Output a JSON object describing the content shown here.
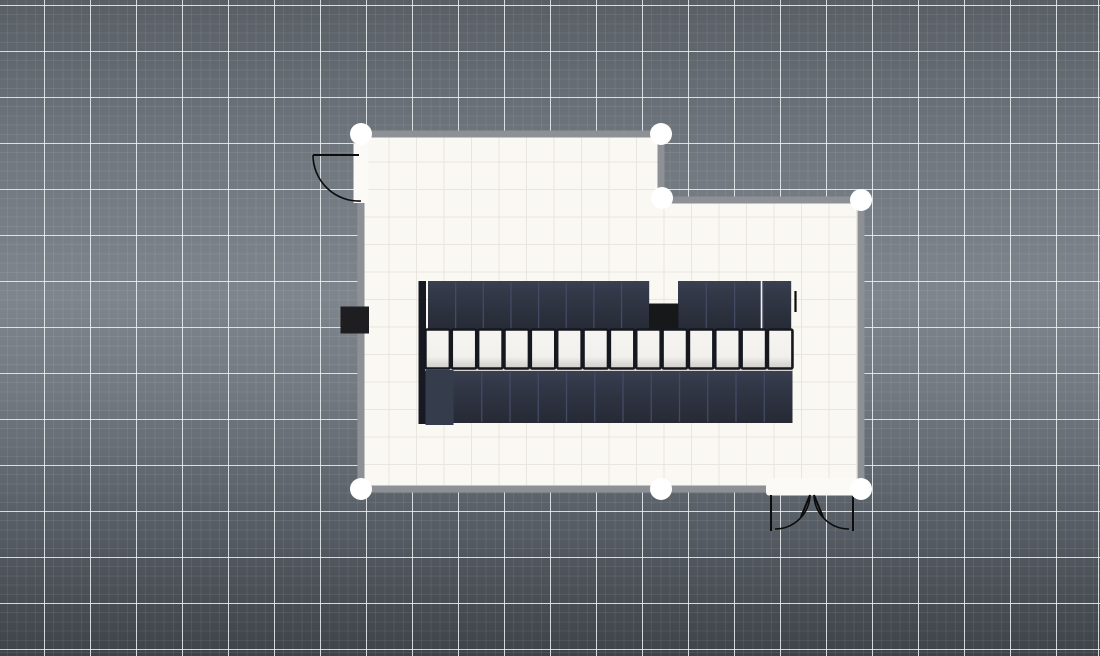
{
  "canvas": {
    "width": 1100,
    "height": 656,
    "background_stops": [
      [
        "#585e64",
        0
      ],
      [
        "#6f767d",
        22
      ],
      [
        "#7e858c",
        45
      ],
      [
        "#747b82",
        58
      ],
      [
        "#575d64",
        80
      ],
      [
        "#3e4349",
        100
      ]
    ],
    "grid": {
      "minor_step": 9.2,
      "major_step": 46,
      "minor_color": "rgba(255,255,255,0.07)",
      "major_color": "rgba(241,245,248,0.82)",
      "offset_x": -2,
      "offset_y": -6
    }
  },
  "room": {
    "floor_color": "#faf8f2",
    "floor_grid": {
      "step": 27.5,
      "color": "#e9e6e0",
      "origin_x": 361,
      "origin_y": 134
    },
    "wall": {
      "color": "#8d9094",
      "thickness": 7
    },
    "outline": [
      [
        361,
        134
      ],
      [
        661,
        134
      ],
      [
        661,
        200
      ],
      [
        861,
        200
      ],
      [
        861,
        489
      ],
      [
        361,
        489
      ]
    ],
    "handles": {
      "radius": 11,
      "color": "#ffffff",
      "points": [
        [
          361,
          134
        ],
        [
          661,
          134
        ],
        [
          662,
          198
        ],
        [
          861,
          200
        ],
        [
          861,
          489
        ],
        [
          661,
          489
        ],
        [
          361,
          489
        ]
      ]
    },
    "doors": {
      "stroke": "#0c0c0c",
      "gap_color": "#fbfaf6",
      "single_left": {
        "gap": [
          353.5,
          144,
          15,
          59
        ],
        "leaf": [
          313,
          155,
          359,
          155
        ],
        "arc": "M 313 155 A 46 46 0 0 0 361 201"
      },
      "double_bottom": {
        "gap": [
          766,
          478.5,
          92,
          17
        ],
        "jambs": [
          [
            771,
            495,
            771,
            531
          ],
          [
            853,
            495,
            853,
            531
          ]
        ],
        "leaves": [
          [
            810,
            495,
            801,
            517
          ],
          [
            814,
            495,
            823,
            517
          ]
        ],
        "arcs": [
          "M 810 495 A 35 35 0 0 1 775 529",
          "M 814 495 A 35 35 0 0 0 849 529"
        ]
      }
    },
    "wall_box": {
      "rect": [
        340.5,
        306.5,
        28.5,
        27
      ],
      "color": "#1e1e20"
    }
  },
  "furniture": {
    "desk_gradient": [
      [
        "#3a4050",
        0
      ],
      [
        "#333848",
        25
      ],
      [
        "#262a35",
        100
      ]
    ],
    "separator_color": "#434a64",
    "chair_gradient": [
      [
        "#f7f5f1",
        0
      ],
      [
        "#f2f0ec",
        70
      ],
      [
        "#dddbd7",
        86
      ],
      [
        "#d2d0cc",
        100
      ]
    ],
    "chair_frame_color": "#15181f",
    "left_panel": {
      "rect": [
        418.5,
        281,
        7.5,
        143
      ],
      "color": "#171a22"
    },
    "desk_rows": [
      {
        "y": 281,
        "h": 50,
        "segments": [
          {
            "x": 428,
            "count": 8,
            "w": 27.65
          },
          {
            "x": 678,
            "count": 4,
            "w": 28.3
          }
        ]
      },
      {
        "y": 371,
        "h": 52,
        "segments": [
          {
            "x": 453.5,
            "count": 12,
            "w": 28.25
          }
        ]
      }
    ],
    "special_desk": {
      "rect": [
        425.5,
        370,
        28,
        55
      ],
      "color": "#353c4c"
    },
    "white_divider": {
      "x": 761.5,
      "y1": 281,
      "y2": 331,
      "color": "#f5f3ee",
      "width": 1.6
    },
    "gap_box": {
      "rect": [
        649,
        303.5,
        29.5,
        27.5
      ],
      "color": "#17181a"
    },
    "shadow_strip": {
      "rect": [
        425,
        361,
        368,
        10
      ],
      "color": "#d7d4d0"
    },
    "chairs": {
      "y": 329.5,
      "h": 39,
      "start_x": 425.4,
      "pitch": 26.35,
      "count": 14,
      "w": 24.5,
      "frame_width": 2.6
    },
    "edge_tick": {
      "x": 795.5,
      "y1": 291,
      "y2": 312,
      "color": "#0b0b0c",
      "width": 2.2
    }
  }
}
